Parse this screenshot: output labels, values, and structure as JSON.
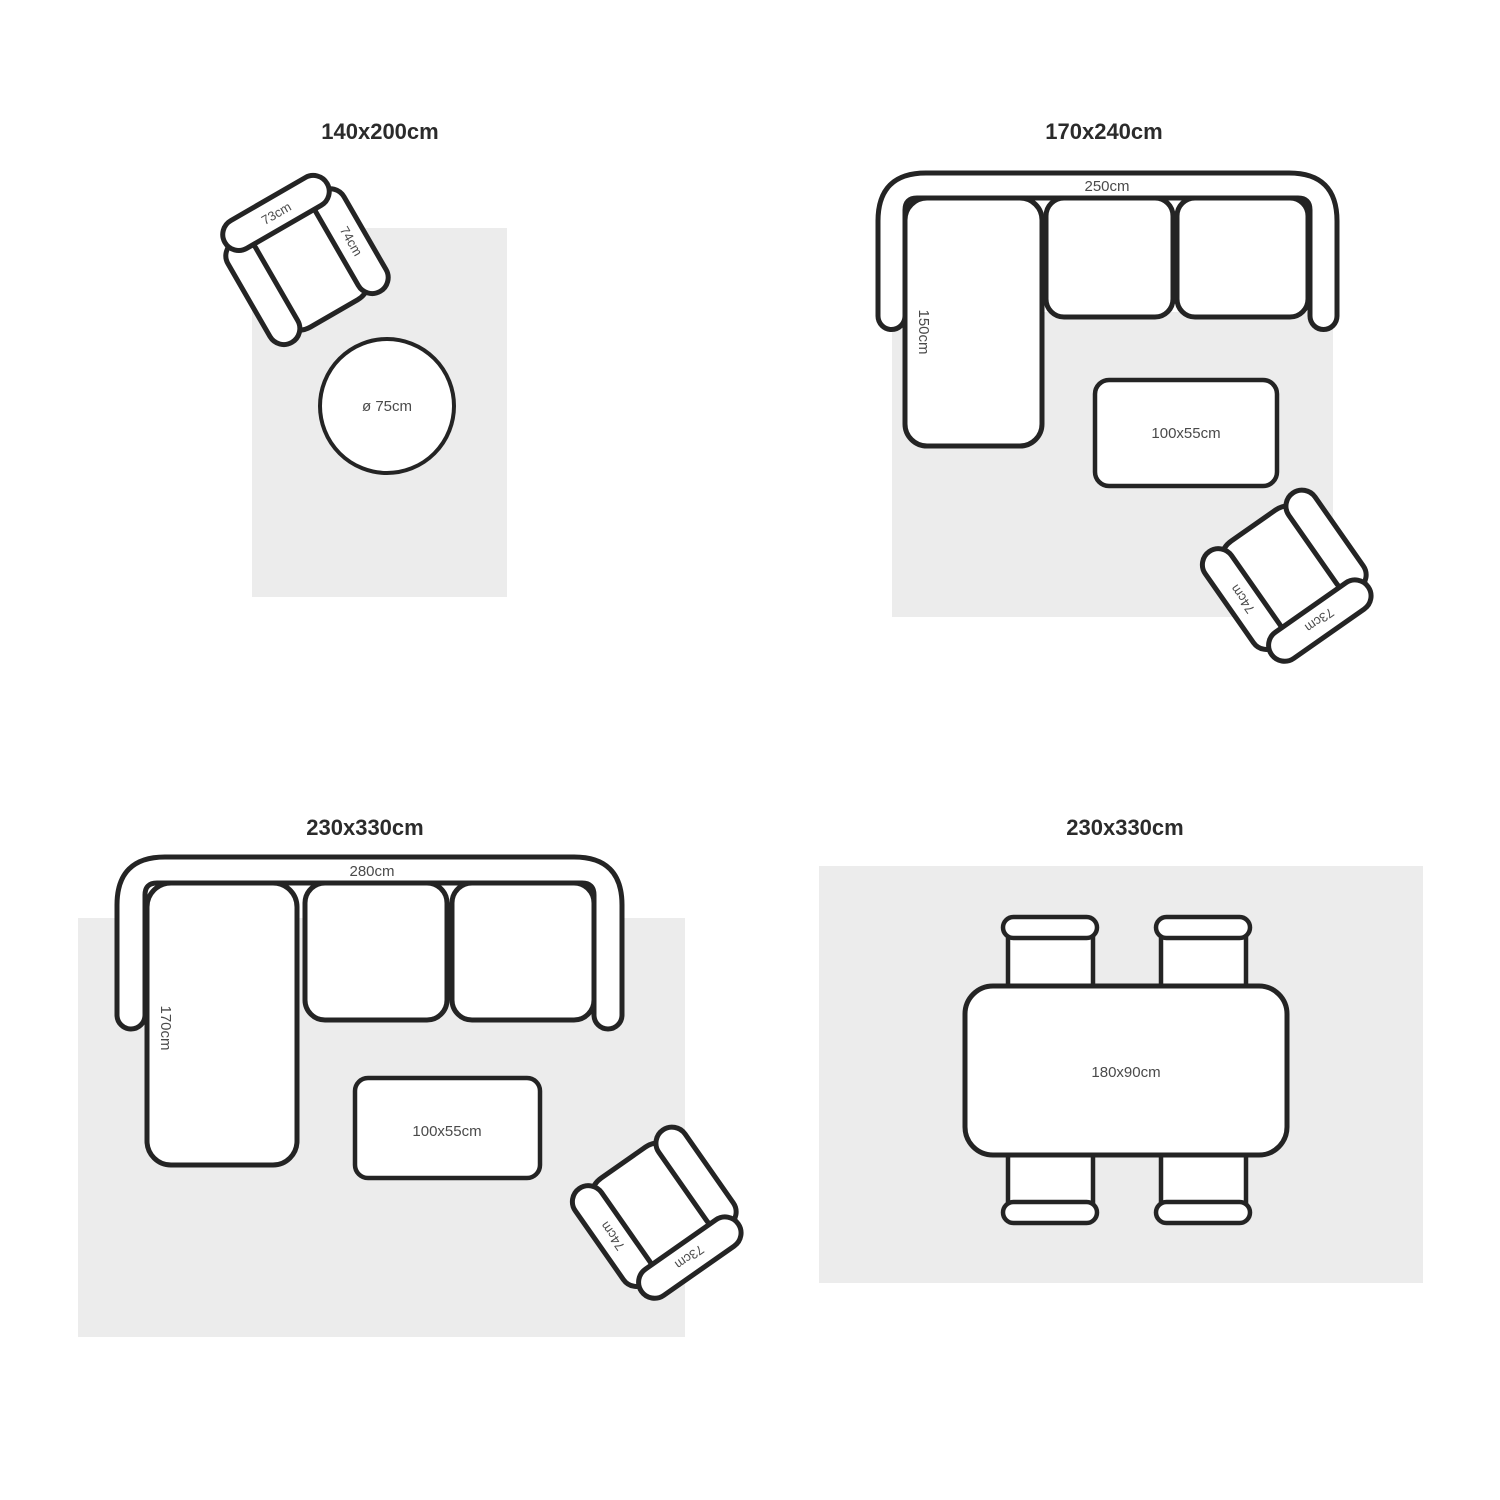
{
  "colors": {
    "outline": "#242424",
    "rug_fill": "#ececec",
    "label_text": "#4a4a4a",
    "title_text": "#2b2b2b",
    "background": "#ffffff"
  },
  "panels": [
    {
      "title": "140x200cm",
      "armchair": {
        "width_label": "73cm",
        "depth_label": "74cm"
      },
      "round_rug_label": "ø 75cm"
    },
    {
      "title": "170x240cm",
      "sofa": {
        "width_label": "250cm",
        "chaise_label": "150cm"
      },
      "coffee_table_label": "100x55cm",
      "armchair": {
        "width_label": "73cm",
        "depth_label": "74cm"
      }
    },
    {
      "title": "230x330cm",
      "sofa": {
        "width_label": "280cm",
        "chaise_label": "170cm"
      },
      "coffee_table_label": "100x55cm",
      "armchair": {
        "width_label": "73cm",
        "depth_label": "74cm"
      }
    },
    {
      "title": "230x330cm",
      "dining_table_label": "180x90cm"
    }
  ]
}
